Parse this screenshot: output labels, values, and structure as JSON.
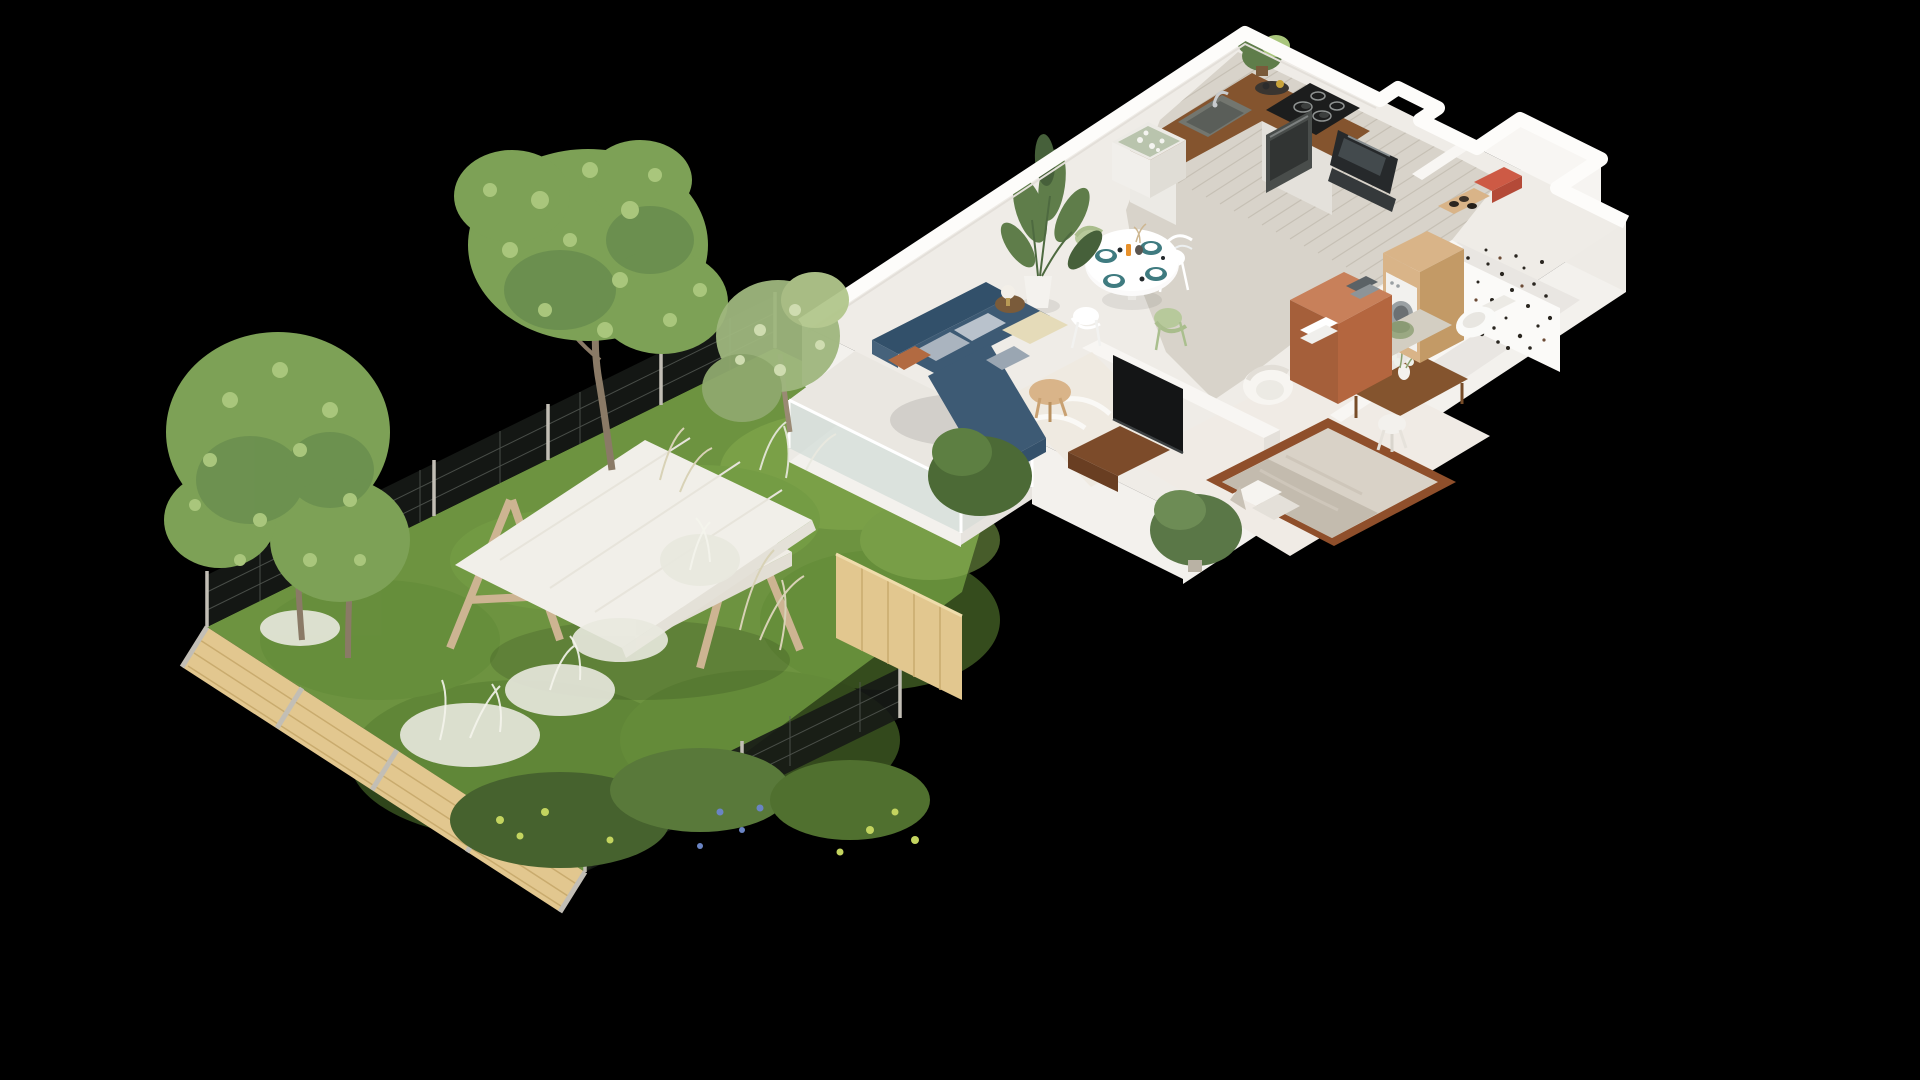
{
  "scene": {
    "kind": "isometric-3d-floor-plan-render",
    "background": "#000000",
    "rooms": [
      "kitchen",
      "dining-area",
      "living-room",
      "hallway",
      "bedroom",
      "bathroom",
      "entry",
      "terrace",
      "garden"
    ],
    "kitchen_objects": [
      "wood-l-counter",
      "sink",
      "faucet",
      "induction-hob",
      "built-in-oven",
      "kitchen-island",
      "potted-herb",
      "serving-tray"
    ],
    "dining_objects": [
      "round-white-table",
      "teal-placemats",
      "white-wire-chairs",
      "green-chairs",
      "strelitzia-plant"
    ],
    "living_objects": [
      "navy-corner-sofa",
      "grey-pillows",
      "rust-pillow",
      "cream-rug",
      "round-coffee-table",
      "side-table-lamp",
      "beige-pouf",
      "tv-panel",
      "wood-media-console"
    ],
    "bedroom_objects": [
      "wood-frame-bed",
      "pillows",
      "white-armchair",
      "dressing-table",
      "white-stool",
      "flower-vase"
    ],
    "bathroom_objects": [
      "washing-machine",
      "wood-cabinet-column",
      "green-vessel-sink",
      "toilet",
      "terracotta-vanity",
      "towels",
      "terrazzo-speckle-wall"
    ],
    "entry_objects": [
      "dark-mirror-panel",
      "shoe-shelf",
      "red-storage-box"
    ],
    "terrace_objects": [
      "glass-balustrade"
    ],
    "garden_objects": [
      "lawn",
      "swing-bench-with-canopy",
      "a-frame-swing",
      "mesh-fence",
      "wood-plank-fence",
      "wood-privacy-panel",
      "trees",
      "ornamental-white-grasses",
      "flower-bushes"
    ]
  },
  "palette": {
    "bg": "#000000",
    "wall": "#f8f6f3",
    "wall_bright": "#fdfcfa",
    "wall_shadow": "#ddd9d3",
    "slab_face": "#f3f1ed",
    "floor_base": "#efece7",
    "floor_wood": "#d8d3ca",
    "plank_line": "#c6c0b5",
    "floor_bath": "#e9e6e2",
    "floor_bed": "#f0ebe5",
    "counter_wood": "#84542e",
    "counter_front": "#6f4525",
    "cab_white": "#eceae5",
    "sink_grey": "#73766f",
    "hob_black": "#1c1d1d",
    "oven_grey": "#494d4b",
    "island_glass": "#b9c4ad",
    "plant_green": "#5f7d4a",
    "plant_dark": "#46603a",
    "pot_white": "#f4f2ee",
    "table_white": "#fbfafa",
    "placemat_teal": "#3f7b80",
    "chair_green": "#b7c99b",
    "sofa_blue": "#3d5a74",
    "sofa_dark": "#32506a",
    "pillow_grey": "#aab4bf",
    "pillow_rust": "#b26a41",
    "rug_cream": "#efeae1",
    "pouf_beige": "#e5dbb9",
    "coffee_wood": "#d9b489",
    "tv_black": "#141516",
    "console_wood": "#7c4b2a",
    "bed_frame": "#8f4f2b",
    "bedding": "#d9d2c7",
    "bedding_fold": "#c3bbae",
    "pillow_white": "#f6f4f0",
    "terracotta": "#a55f3a",
    "terracotta_top": "#c8805a",
    "washer_white": "#f2f1ee",
    "washer_door": "#9aa0a3",
    "vanity_wood": "#d9b488",
    "vanity_wood_dark": "#c39a66",
    "bowl_green": "#9aa882",
    "toilet_white": "#fafaf8",
    "mirror_dark": "#26292b",
    "red_box": "#cd5a45",
    "glass_blue": "#ccd8d3",
    "terrace_floor": "#eae7e1",
    "grass_base": "#6d9340",
    "grass_light": "#85ab4e",
    "grass_dark": "#567d31",
    "foliage": "#7da156",
    "foliage_light": "#a9c67c",
    "foliage_dark": "#5d824a",
    "grass_white": "#e9e9df",
    "straw": "#d8d2b6",
    "fence_wood": "#e2c78f",
    "fence_wood_dark": "#c9ab6e",
    "fence_post": "#c2beb5",
    "mesh_dark": "#161916",
    "mesh_line": "#565b55",
    "canopy_white": "#f1efe9",
    "frame_wood": "#cdb492",
    "seat_cushion": "#f0ede6",
    "wicker": "#c8ae85",
    "trunk_brown": "#8a7a66",
    "speckle_dark": "#2a2620",
    "bush_dark": "#46622e",
    "flower_yellow": "#c3d45f",
    "flower_blue": "#6a84c4"
  }
}
